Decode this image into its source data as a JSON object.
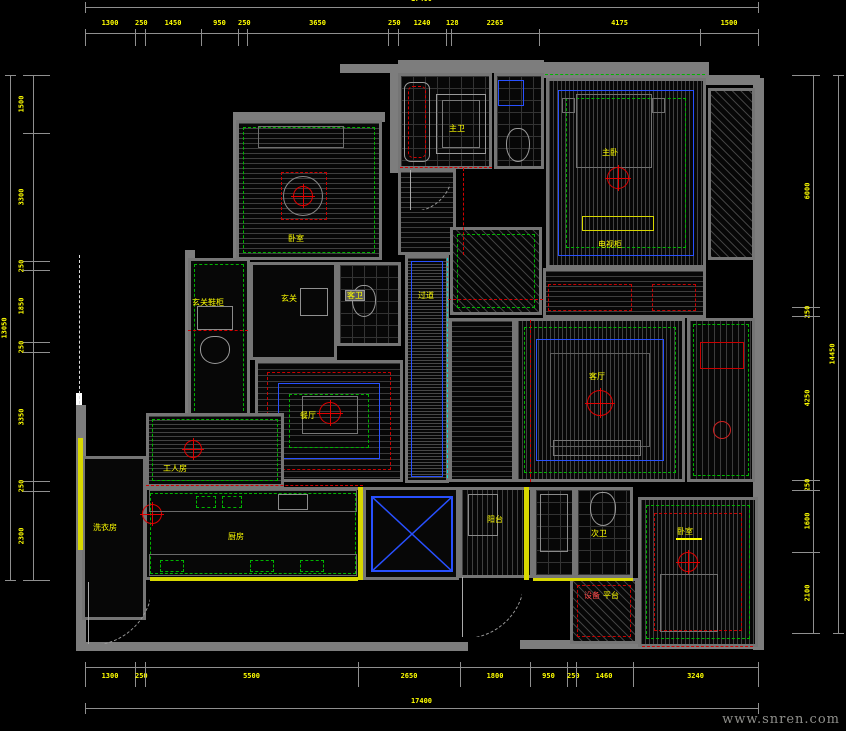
{
  "watermark": "www.snren.com",
  "colors": {
    "background": "#000000",
    "dimension_text": "#ffff00",
    "dimension_line": "#8f8f8f",
    "wall": "#7d7d7d",
    "green_accent": "#00b400",
    "red_accent": "#d40000",
    "blue_accent": "#2850ff",
    "yellow_accent": "#d8d800",
    "cyan_accent": "#00dede"
  },
  "dimensions": {
    "top": {
      "total": "17400",
      "segments": [
        "1300",
        "250",
        "1450",
        "950",
        "250",
        "3650",
        "250",
        "1240",
        "128",
        "2265",
        "4175",
        "1500"
      ]
    },
    "bottom": {
      "total": "17400",
      "segments": [
        "1300",
        "250",
        "5500",
        "2650",
        "1800",
        "950",
        "250",
        "1460",
        "3240"
      ]
    },
    "left": {
      "total": "13050",
      "segments": [
        "1500",
        "3300",
        "250",
        "1850",
        "250",
        "3350",
        "250",
        "2300"
      ]
    },
    "right": {
      "total": "14450",
      "segments": [
        "6000",
        "250",
        "4250",
        "250",
        "1600",
        "2100"
      ]
    }
  },
  "plan": {
    "rooms": [
      {
        "id": "bedroom-top-left",
        "r": [
          236,
          120,
          146,
          140
        ],
        "h": "hatch-h5",
        "ins": [
          [
            4,
            "#00b400",
            "dashed"
          ]
        ]
      },
      {
        "id": "master-bath",
        "r": [
          398,
          73,
          94,
          96
        ],
        "h": "hatch-grid",
        "ins": []
      },
      {
        "id": "closet-top",
        "r": [
          494,
          73,
          50,
          96
        ],
        "h": "hatch-grid",
        "ins": []
      },
      {
        "id": "master-bedroom",
        "r": [
          546,
          78,
          160,
          190
        ],
        "h": "hatch-v4",
        "ins": [
          [
            9,
            "#2850ff",
            "solid"
          ],
          [
            17,
            "#00b400",
            "dashed"
          ]
        ]
      },
      {
        "id": "master-hall",
        "r": [
          398,
          169,
          58,
          86
        ],
        "h": "hatch-h5",
        "ins": []
      },
      {
        "id": "wardrobe",
        "r": [
          450,
          227,
          92,
          88
        ],
        "h": "hatch-d",
        "ins": [
          [
            4,
            "#00b400",
            "dashed"
          ]
        ]
      },
      {
        "id": "guest-bath",
        "r": [
          337,
          262,
          64,
          84
        ],
        "h": "hatch-grid",
        "ins": []
      },
      {
        "id": "foyer",
        "r": [
          250,
          262,
          87,
          98
        ],
        "h": "",
        "ins": []
      },
      {
        "id": "shoe-cabinet-room",
        "r": [
          188,
          258,
          62,
          164
        ],
        "h": "",
        "ins": [
          [
            3,
            "#00b400",
            "dashed"
          ]
        ]
      },
      {
        "id": "corridor",
        "r": [
          405,
          255,
          44,
          228
        ],
        "h": "hatch-h3",
        "ins": [
          [
            3,
            "#2850ff",
            "solid"
          ]
        ]
      },
      {
        "id": "mid-hall",
        "r": [
          449,
          318,
          66,
          164
        ],
        "h": "hatch-h5",
        "ins": []
      },
      {
        "id": "dining-room",
        "r": [
          255,
          360,
          148,
          122
        ],
        "h": "hatch-h6",
        "ins": [
          [
            9,
            "#c80000",
            "dashed"
          ],
          [
            20,
            "#2850ff",
            "solid"
          ],
          [
            31,
            "#00b400",
            "dashed"
          ]
        ]
      },
      {
        "id": "living-room",
        "r": [
          515,
          318,
          170,
          164
        ],
        "h": "hatch-v4",
        "ins": [
          [
            6,
            "#00b400",
            "dashed"
          ],
          [
            18,
            "#2850ff",
            "solid"
          ],
          [
            32,
            "#606060",
            "solid"
          ]
        ]
      },
      {
        "id": "balcony-right",
        "r": [
          687,
          318,
          68,
          164
        ],
        "h": "hatch-v6",
        "ins": [
          [
            3,
            "#00b400",
            "dashed"
          ]
        ]
      },
      {
        "id": "bay-strip-top-right",
        "r": [
          708,
          88,
          47,
          172
        ],
        "h": "hatch-d",
        "ins": []
      },
      {
        "id": "wardrobe-band",
        "r": [
          543,
          268,
          163,
          50
        ],
        "h": "hatch-h5",
        "ins": []
      },
      {
        "id": "maid-room",
        "r": [
          146,
          413,
          138,
          74
        ],
        "h": "hatch-h4",
        "ins": [
          [
            3,
            "#00b400",
            "dashed"
          ]
        ]
      },
      {
        "id": "laundry",
        "r": [
          82,
          456,
          64,
          164
        ],
        "h": "",
        "ins": []
      },
      {
        "id": "kitchen",
        "r": [
          144,
          487,
          218,
          93
        ],
        "h": "",
        "ins": [
          [
            3,
            "#00b400",
            "dashed"
          ]
        ]
      },
      {
        "id": "lightwell",
        "r": [
          363,
          487,
          96,
          93
        ],
        "h": "",
        "ins": []
      },
      {
        "id": "service-balcony",
        "r": [
          459,
          487,
          74,
          91
        ],
        "h": "hatch-v5",
        "ins": []
      },
      {
        "id": "bath2-shower",
        "r": [
          533,
          487,
          42,
          91
        ],
        "h": "hatch-grid",
        "ins": []
      },
      {
        "id": "second-bath",
        "r": [
          575,
          487,
          58,
          91
        ],
        "h": "hatch-grid",
        "ins": []
      },
      {
        "id": "bedroom-bottom-right",
        "r": [
          638,
          497,
          120,
          150
        ],
        "h": "hatch-v4",
        "ins": [
          [
            5,
            "#00b400",
            "dashed"
          ],
          [
            13,
            "#c80000",
            "dashed"
          ]
        ]
      },
      {
        "id": "equipment-platform",
        "r": [
          570,
          578,
          68,
          66
        ],
        "h": "hatch-d",
        "ins": [
          [
            4,
            "#c80000",
            "dashed"
          ]
        ]
      }
    ],
    "walls": [
      [
        398,
        60,
        146,
        13
      ],
      [
        543,
        62,
        166,
        16
      ],
      [
        233,
        112,
        152,
        10
      ],
      [
        233,
        112,
        10,
        148
      ],
      [
        390,
        73,
        12,
        100
      ],
      [
        753,
        78,
        11,
        572
      ],
      [
        700,
        75,
        60,
        10
      ],
      [
        185,
        250,
        10,
        175
      ],
      [
        76,
        405,
        10,
        245
      ],
      [
        76,
        642,
        392,
        9
      ],
      [
        520,
        640,
        240,
        9
      ],
      [
        340,
        64,
        68,
        9
      ]
    ],
    "accent_bars": [
      {
        "r": [
          78,
          438,
          5,
          112
        ],
        "c": "#d8d800"
      },
      {
        "r": [
          358,
          487,
          5,
          93
        ],
        "c": "#d8d800"
      },
      {
        "r": [
          524,
          487,
          5,
          93
        ],
        "c": "#d8d800"
      },
      {
        "r": [
          150,
          577,
          208,
          4
        ],
        "c": "#d8d800"
      },
      {
        "r": [
          533,
          578,
          100,
          3
        ],
        "c": "#d8d800"
      },
      {
        "r": [
          76,
          393,
          6,
          12
        ],
        "c": "#ffffff"
      },
      {
        "r": [
          676,
          538,
          26,
          2
        ],
        "c": "#ffff00"
      }
    ],
    "lines": [
      {
        "o": "h",
        "x": 448,
        "y": 299,
        "len": 95,
        "c": "#d40000",
        "s": "dashed"
      },
      {
        "o": "v",
        "x": 463,
        "y": 168,
        "len": 87,
        "c": "#d40000",
        "s": "dashed"
      },
      {
        "o": "h",
        "x": 146,
        "y": 485,
        "len": 217,
        "c": "#d40000",
        "s": "dashed"
      },
      {
        "o": "v",
        "x": 530,
        "y": 320,
        "len": 162,
        "c": "#d40000",
        "s": "dashed"
      },
      {
        "o": "h",
        "x": 642,
        "y": 646,
        "len": 111,
        "c": "#d40000",
        "s": "dashed"
      },
      {
        "o": "h",
        "x": 188,
        "y": 330,
        "len": 60,
        "c": "#d40000",
        "s": "dashed"
      },
      {
        "o": "h",
        "x": 400,
        "y": 167,
        "len": 92,
        "c": "#d40000",
        "s": "dashed"
      },
      {
        "o": "v",
        "x": 447,
        "y": 258,
        "len": 220,
        "c": "#00dede",
        "s": "dashed"
      },
      {
        "o": "v",
        "x": 79,
        "y": 255,
        "len": 149,
        "c": "#dddddd",
        "s": "dashed"
      },
      {
        "o": "h",
        "x": 545,
        "y": 74,
        "len": 160,
        "c": "#00b400",
        "s": "dashed"
      }
    ],
    "fixtures": [
      {
        "t": "tub",
        "r": [
          404,
          82,
          26,
          80
        ]
      },
      {
        "t": "box",
        "r": [
          436,
          94,
          50,
          60
        ],
        "c": "#9a9a9a"
      },
      {
        "t": "box",
        "r": [
          442,
          100,
          38,
          48
        ],
        "c": "#787878"
      },
      {
        "t": "box",
        "r": [
          498,
          80,
          26,
          26
        ],
        "c": "#2850ff"
      },
      {
        "t": "toilet",
        "r": [
          506,
          128,
          24,
          34
        ]
      },
      {
        "t": "box",
        "r": [
          576,
          94,
          76,
          74
        ],
        "c": "#707070"
      },
      {
        "t": "box",
        "r": [
          562,
          98,
          13,
          15
        ],
        "c": "#707070"
      },
      {
        "t": "box",
        "r": [
          652,
          98,
          13,
          15
        ],
        "c": "#707070"
      },
      {
        "t": "box",
        "r": [
          582,
          216,
          72,
          15
        ],
        "c": "#d8d800"
      },
      {
        "t": "fan",
        "cx": 618,
        "cy": 178,
        "r": 11
      },
      {
        "t": "box",
        "r": [
          258,
          126,
          86,
          22
        ],
        "c": "#707070"
      },
      {
        "t": "circle",
        "cx": 303,
        "cy": 196,
        "r": 20,
        "c": "#888888"
      },
      {
        "t": "fan",
        "cx": 303,
        "cy": 196,
        "r": 10
      },
      {
        "t": "box",
        "r": [
          281,
          172,
          46,
          48
        ],
        "c": "#c80000",
        "s": "dashed"
      },
      {
        "t": "chand",
        "cx": 330,
        "cy": 413,
        "r": 11
      },
      {
        "t": "box",
        "r": [
          302,
          396,
          56,
          38
        ],
        "c": "#777777"
      },
      {
        "t": "chand",
        "cx": 600,
        "cy": 403,
        "r": 13
      },
      {
        "t": "box",
        "r": [
          553,
          440,
          88,
          16
        ],
        "c": "#777777"
      },
      {
        "t": "box",
        "r": [
          548,
          284,
          84,
          27
        ],
        "c": "#c80000",
        "s": "dashed"
      },
      {
        "t": "box",
        "r": [
          652,
          284,
          44,
          27
        ],
        "c": "#c80000",
        "s": "dashed"
      },
      {
        "t": "box",
        "r": [
          700,
          342,
          44,
          27
        ],
        "c": "#c80000"
      },
      {
        "t": "circle",
        "cx": 722,
        "cy": 430,
        "r": 9,
        "c": "#cc2020"
      },
      {
        "t": "box",
        "r": [
          300,
          288,
          28,
          28
        ],
        "c": "#909090"
      },
      {
        "t": "box",
        "r": [
          197,
          306,
          36,
          24
        ],
        "c": "#8a8a8a"
      },
      {
        "t": "toilet",
        "r": [
          200,
          336,
          30,
          28
        ]
      },
      {
        "t": "toilet",
        "r": [
          352,
          285,
          24,
          32
        ]
      },
      {
        "t": "fan",
        "cx": 193,
        "cy": 449,
        "r": 9
      },
      {
        "t": "fan",
        "cx": 152,
        "cy": 514,
        "r": 10
      },
      {
        "t": "box",
        "r": [
          149,
          490,
          208,
          22
        ],
        "c": "#6a6a6a"
      },
      {
        "t": "box",
        "r": [
          196,
          496,
          20,
          12
        ],
        "c": "#00b400",
        "s": "dashed"
      },
      {
        "t": "box",
        "r": [
          222,
          496,
          20,
          12
        ],
        "c": "#00b400",
        "s": "dashed"
      },
      {
        "t": "box",
        "r": [
          278,
          494,
          30,
          16
        ],
        "c": "#8a8a8a"
      },
      {
        "t": "box",
        "r": [
          149,
          554,
          208,
          22
        ],
        "c": "#6a6a6a"
      },
      {
        "t": "box",
        "r": [
          160,
          560,
          24,
          12
        ],
        "c": "#00b400",
        "s": "dashed"
      },
      {
        "t": "box",
        "r": [
          250,
          560,
          24,
          12
        ],
        "c": "#00b400",
        "s": "dashed"
      },
      {
        "t": "box",
        "r": [
          300,
          560,
          24,
          12
        ],
        "c": "#00b400",
        "s": "dashed"
      },
      {
        "t": "xbox",
        "r": [
          371,
          496,
          82,
          76
        ]
      },
      {
        "t": "box",
        "r": [
          468,
          494,
          30,
          42
        ],
        "c": "#8a8a8a"
      },
      {
        "t": "toilet",
        "r": [
          590,
          492,
          26,
          34
        ]
      },
      {
        "t": "box",
        "r": [
          540,
          494,
          28,
          58
        ],
        "c": "#8a8a8a"
      },
      {
        "t": "box",
        "r": [
          660,
          574,
          58,
          58
        ],
        "c": "#707070"
      },
      {
        "t": "fan",
        "cx": 688,
        "cy": 562,
        "r": 10
      },
      {
        "t": "arc",
        "x": 88,
        "y": 582,
        "r": 62
      },
      {
        "t": "arc",
        "x": 462,
        "y": 577,
        "r": 60
      },
      {
        "t": "arc",
        "x": 410,
        "y": 170,
        "r": 40
      }
    ],
    "labels": [
      {
        "id": "bedroom-top-left-label",
        "t": "卧室",
        "x": 288,
        "y": 234
      },
      {
        "id": "master-bath-label",
        "t": "主卫",
        "x": 449,
        "y": 124
      },
      {
        "id": "master-bedroom-label",
        "t": "主卧",
        "x": 602,
        "y": 148
      },
      {
        "id": "tv-cabinet-label",
        "t": "电视柜",
        "x": 598,
        "y": 240
      },
      {
        "id": "corridor-label",
        "t": "过道",
        "x": 418,
        "y": 291
      },
      {
        "id": "guest-bath-label",
        "t": "客卫",
        "x": 346,
        "y": 291,
        "boxed": true
      },
      {
        "id": "foyer-label",
        "t": "玄关",
        "x": 281,
        "y": 294
      },
      {
        "id": "shoe-cabinet-label",
        "t": "玄关鞋柜",
        "x": 192,
        "y": 298
      },
      {
        "id": "dining-room-label",
        "t": "餐厅",
        "x": 300,
        "y": 411
      },
      {
        "id": "living-room-label",
        "t": "客厅",
        "x": 589,
        "y": 372
      },
      {
        "id": "maid-room-label",
        "t": "工人房",
        "x": 163,
        "y": 464
      },
      {
        "id": "laundry-label",
        "t": "洗衣房",
        "x": 93,
        "y": 523
      },
      {
        "id": "kitchen-label",
        "t": "厨房",
        "x": 228,
        "y": 532
      },
      {
        "id": "service-balcony-label",
        "t": "阳台",
        "x": 487,
        "y": 515
      },
      {
        "id": "second-bath-label",
        "t": "次卫",
        "x": 591,
        "y": 529
      },
      {
        "id": "bedroom-bottom-right-label",
        "t": "卧室",
        "x": 677,
        "y": 527
      },
      {
        "id": "equipment-label-1",
        "t": "设备",
        "x": 584,
        "y": 591,
        "c": "#ff4646"
      },
      {
        "id": "equipment-label-2",
        "t": "平台",
        "x": 603,
        "y": 591
      }
    ]
  }
}
